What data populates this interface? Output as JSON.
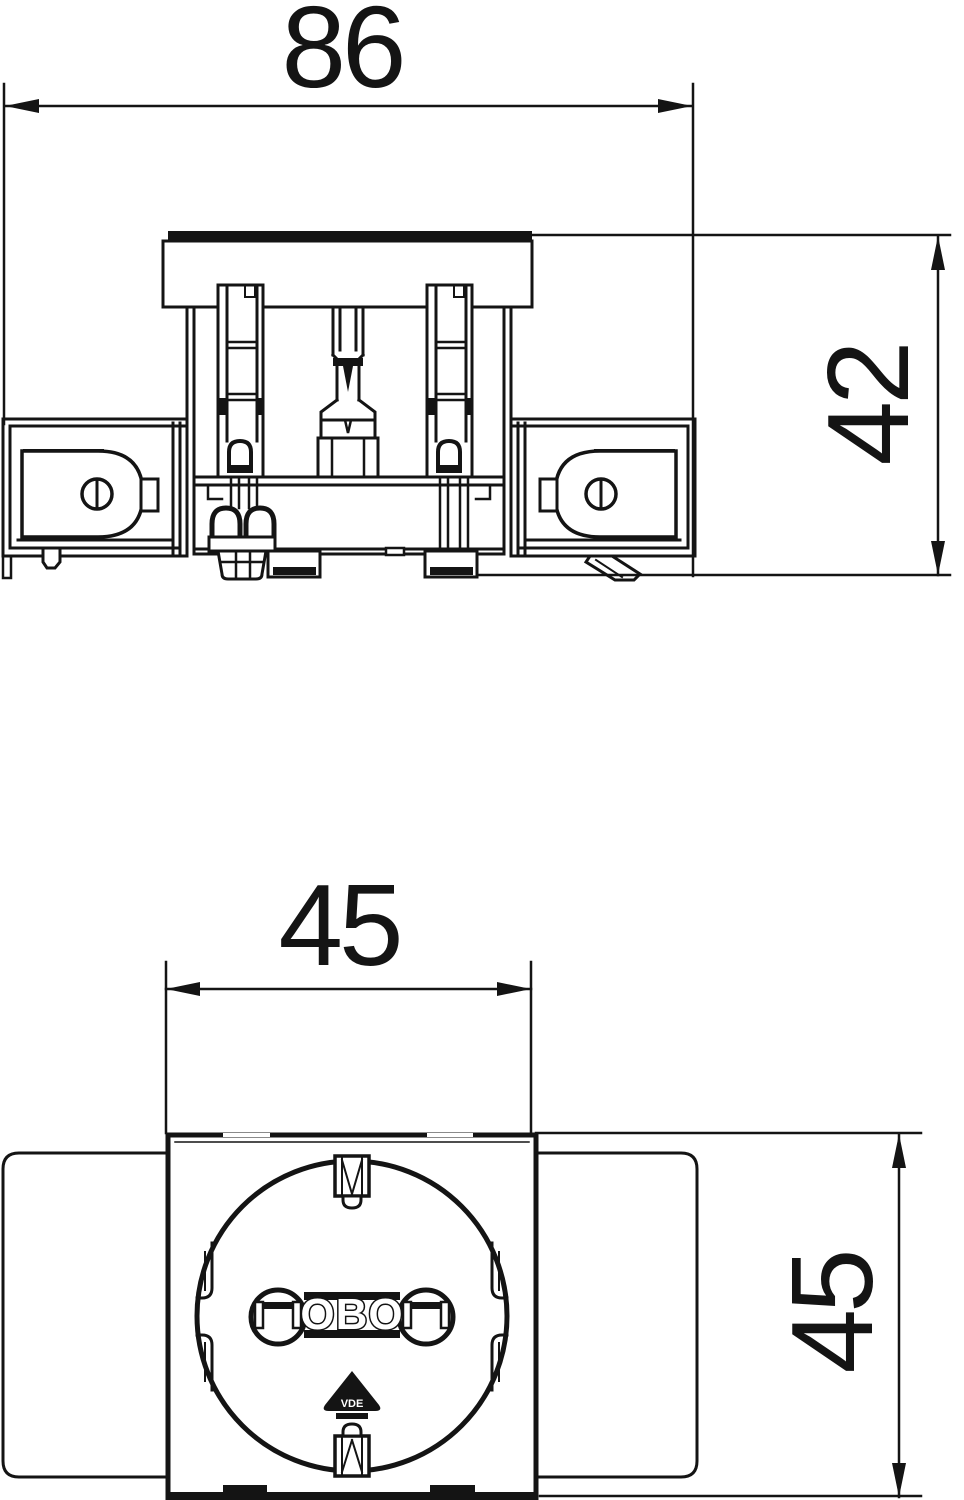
{
  "page": {
    "background": "#ffffff",
    "line_color": "#141414",
    "description": "technical dimension drawing of a socket outlet, side section view above and front view below"
  },
  "side_view": {
    "name": "side-section-view",
    "width_dim_label": "86",
    "height_dim_label": "42"
  },
  "front_view": {
    "name": "front-view",
    "width_dim_label": "45",
    "height_dim_label": "45",
    "socket_logo": "OBO",
    "cert_mark": "VDE"
  }
}
